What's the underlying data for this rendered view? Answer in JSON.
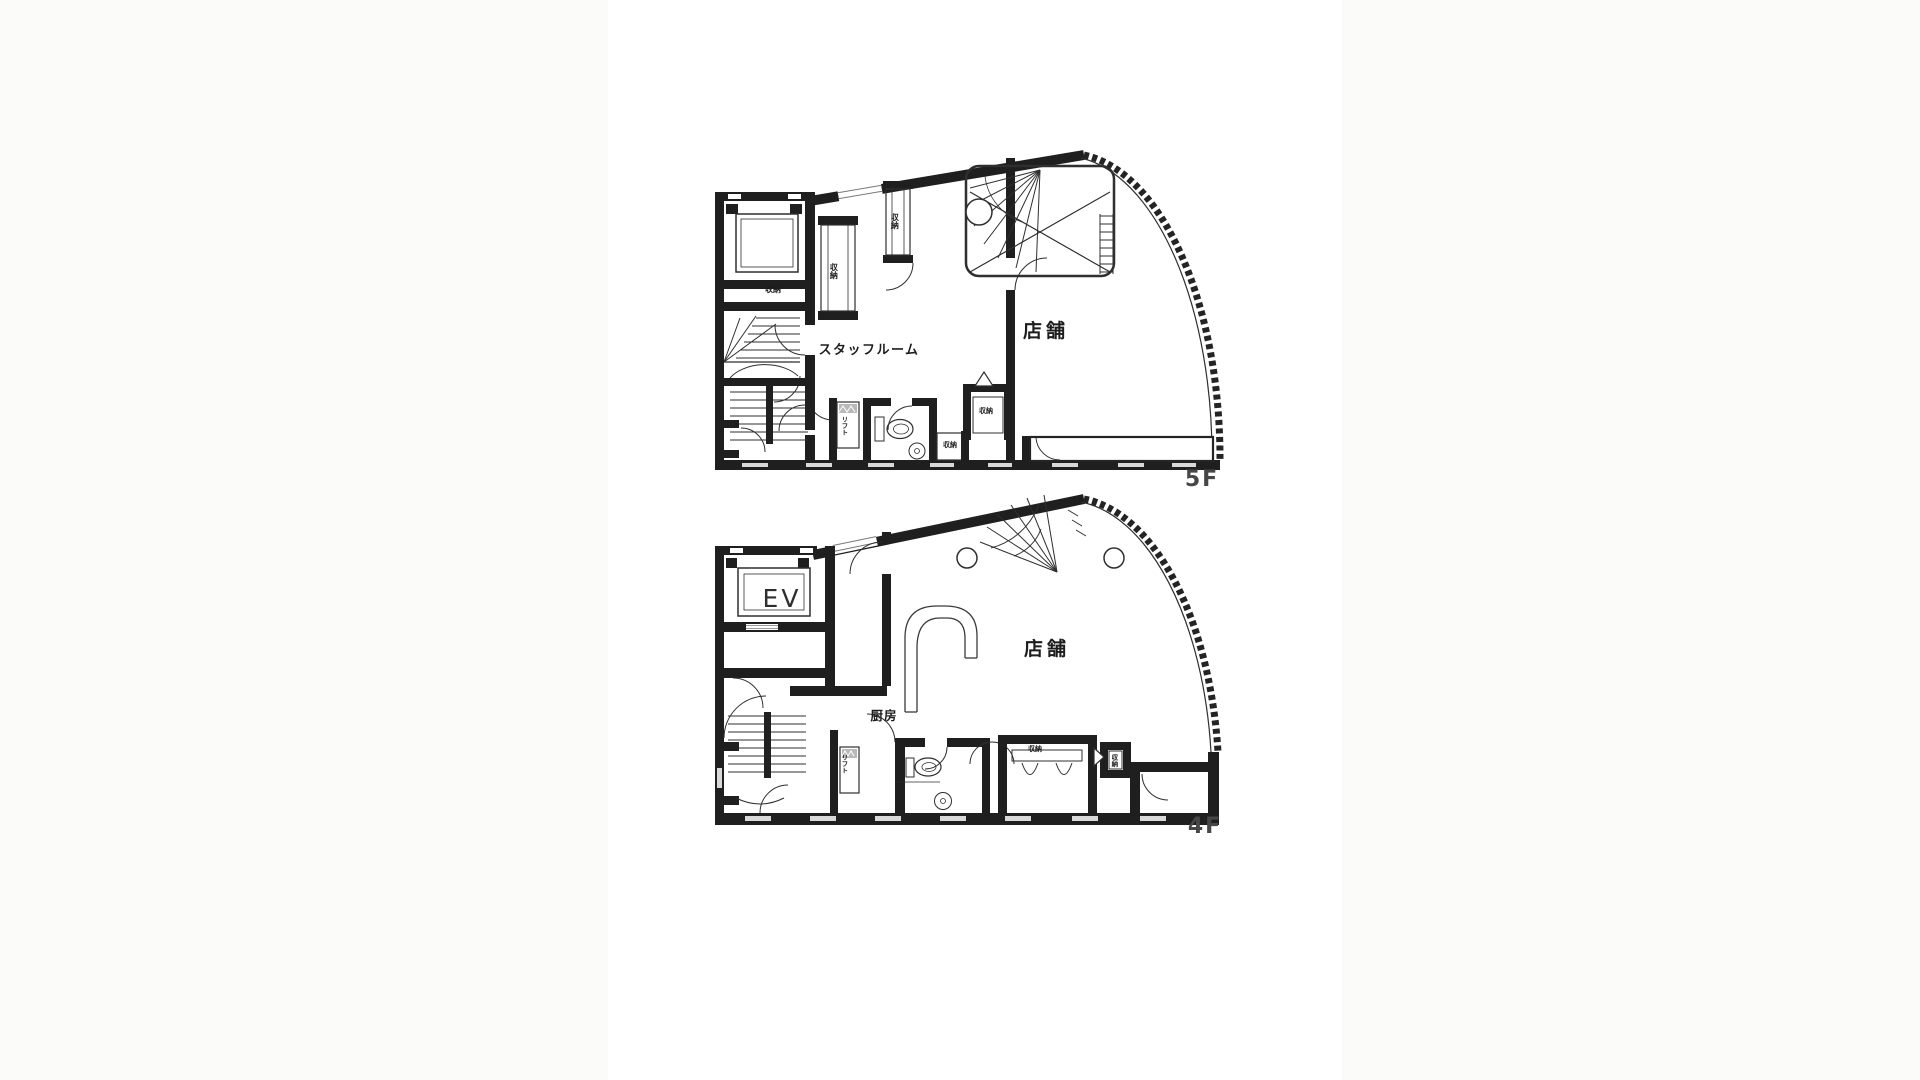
{
  "page": {
    "background_outer": "#fbfbfa",
    "background_panel": "#ffffff",
    "description_title": "Building floor plans 5F / 4F"
  },
  "colors": {
    "wall": "#1f1f1f",
    "line": "#2f2f2f",
    "window_dash": "#d9d9d9",
    "hatch_gray": "#b9b9b9",
    "floor_label": "#474747"
  },
  "plan5f": {
    "floor_label": "5F",
    "labels": {
      "staff_room": "スタッフルーム",
      "store": "店舗",
      "storage_1": "収納",
      "storage_2": "収納",
      "storage_3": "収納",
      "storage_4": "収納",
      "storage_5": "収納",
      "lift": "リフト"
    },
    "fixtures": [
      "elevator-shaft",
      "switchback-staircase",
      "straight-staircase",
      "spiral-staircase",
      "column",
      "storage-closet",
      "toilet",
      "wash-basin",
      "dumbwaiter-lift",
      "curved-window-wall",
      "window-bench"
    ]
  },
  "plan4f": {
    "floor_label": "4F",
    "labels": {
      "elevator": "EV",
      "kitchen": "厨房",
      "store": "店舗",
      "storage_1": "収納",
      "storage_2": "収納",
      "lift": "リフト"
    },
    "fixtures": [
      "elevator",
      "switchback-staircase",
      "open-spiral-staircase",
      "column",
      "service-counter",
      "toilet",
      "wash-basin",
      "dumbwaiter-lift",
      "curved-window-wall",
      "storage-room",
      "window-bench"
    ]
  }
}
